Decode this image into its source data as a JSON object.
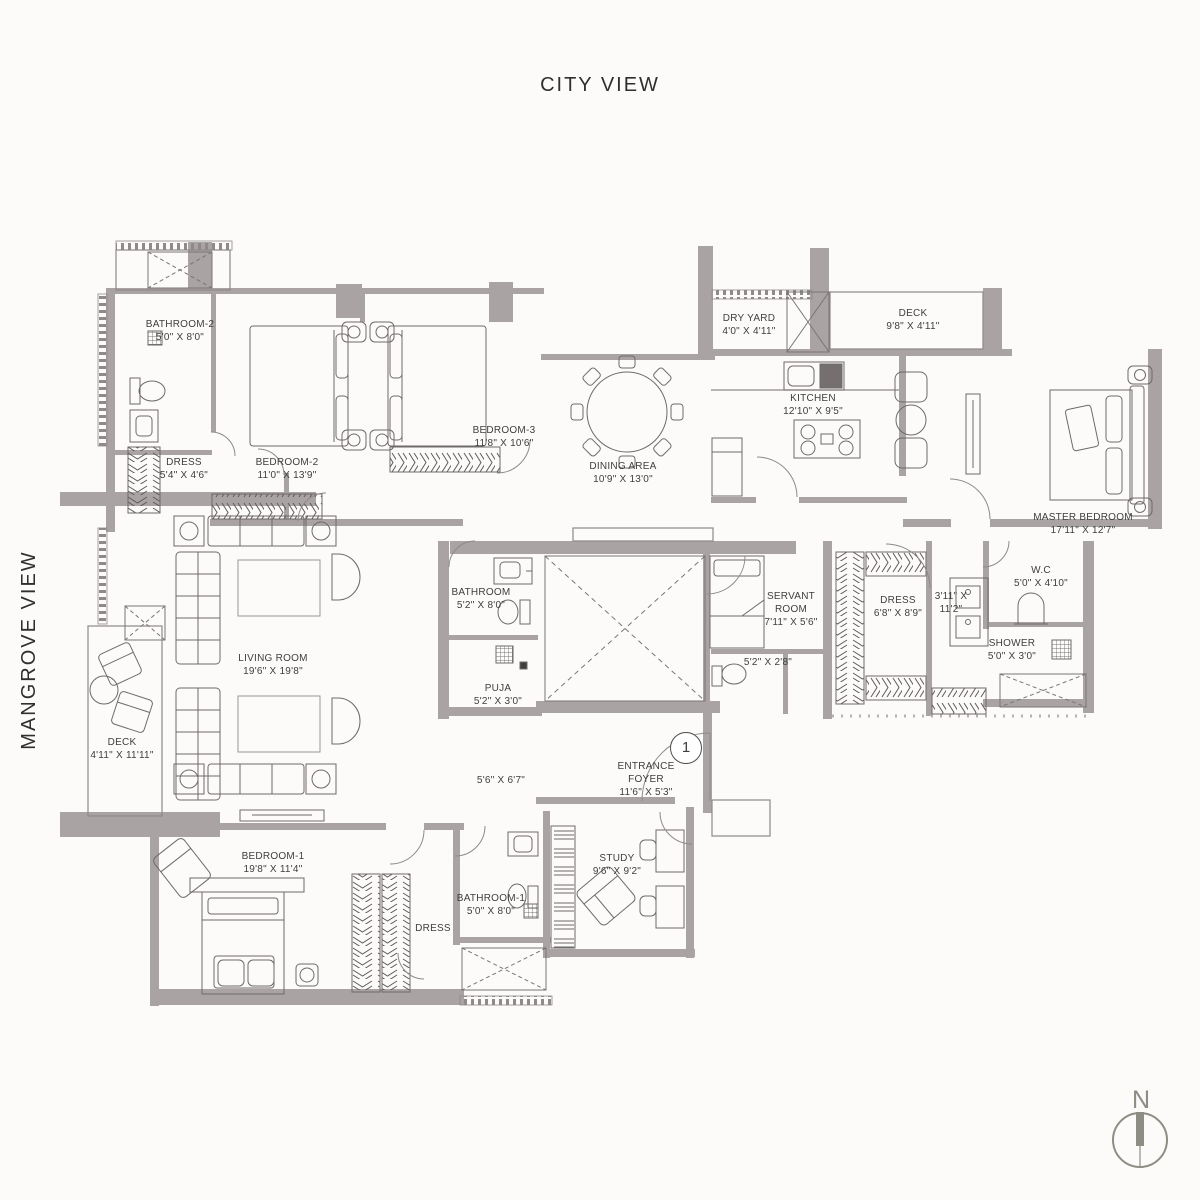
{
  "views": {
    "top": "CITY VIEW",
    "left": "MANGROVE VIEW"
  },
  "compass": {
    "label": "N"
  },
  "entry": {
    "marker": "1"
  },
  "colors": {
    "wall": "#a9a3a3",
    "line": "#8f8989",
    "furniture": "#6f6a6a",
    "text": "#3e3e3e"
  },
  "rooms": [
    {
      "name": "BATHROOM-2",
      "dims": "5'0\" X 8'0\""
    },
    {
      "name": "DRESS",
      "dims": "5'4\" X 4'6\""
    },
    {
      "name": "BEDROOM-2",
      "dims": "11'0\" X 13'9\""
    },
    {
      "name": "BEDROOM-3",
      "dims": "11'8\" X 10'6\""
    },
    {
      "name": "DINING AREA",
      "dims": "10'9\" X 13'0\""
    },
    {
      "name": "DRY YARD",
      "dims": "4'0\" X 4'11\""
    },
    {
      "name": "DECK",
      "dims": "9'8\" X 4'11\""
    },
    {
      "name": "KITCHEN",
      "dims": "12'10\" X 9'5\""
    },
    {
      "name": "MASTER BEDROOM",
      "dims": "17'11\" X 12'7\""
    },
    {
      "name": "LIVING ROOM",
      "dims": "19'6\" X 19'8\""
    },
    {
      "name": "DECK",
      "dims": "4'11\" X 11'11\""
    },
    {
      "name": "BATHROOM",
      "dims": "5'2\" X 8'0\""
    },
    {
      "name": "PUJA",
      "dims": "5'2\" X 3'0\""
    },
    {
      "name": "SERVANT ROOM",
      "dims": "7'11\" X 5'6\""
    },
    {
      "name": "",
      "dims": "5'2\" X 2'8\""
    },
    {
      "name": "DRESS",
      "dims": "6'8\" X 8'9\""
    },
    {
      "name": "",
      "dims": "3'11\" X 11'2\""
    },
    {
      "name": "W.C",
      "dims": "5'0\" X 4'10\""
    },
    {
      "name": "SHOWER",
      "dims": "5'0\" X 3'0\""
    },
    {
      "name": "BEDROOM-1",
      "dims": "19'8\" X 11'4\""
    },
    {
      "name": "DRESS",
      "dims": ""
    },
    {
      "name": "BATHROOM-1",
      "dims": "5'0\" X 8'0\""
    },
    {
      "name": "",
      "dims": "5'6\" X 6'7\""
    },
    {
      "name": "ENTRANCE FOYER",
      "dims": "11'6\" X 5'3\""
    },
    {
      "name": "STUDY",
      "dims": "9'6\" X 9'2\""
    }
  ]
}
